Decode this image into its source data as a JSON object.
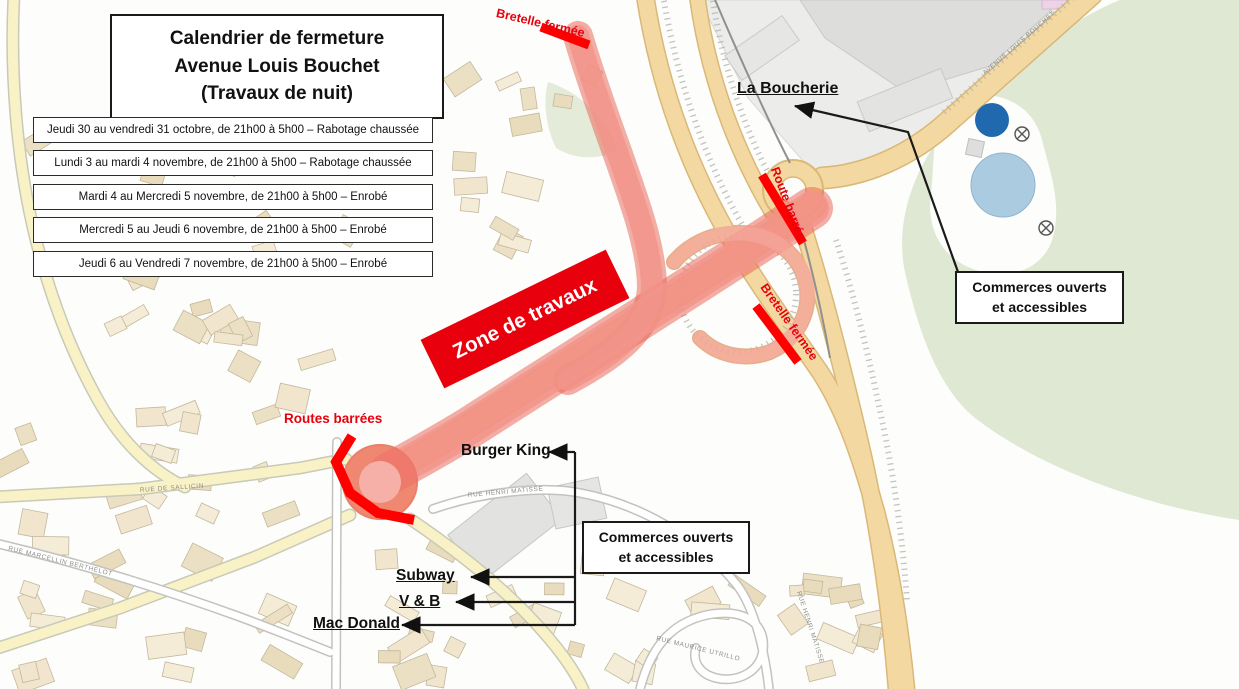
{
  "title": {
    "line1": "Calendrier de fermeture",
    "line2": "Avenue Louis Bouchet",
    "line3": "(Travaux de nuit)"
  },
  "schedule": [
    "Jeudi 30 au vendredi 31 octobre, de 21h00 à 5h00 – Rabotage chaussée",
    "Lundi 3 au mardi 4 novembre, de 21h00 à 5h00 – Rabotage chaussée",
    "Mardi 4 au Mercredi 5 novembre, de 21h00 à 5h00 – Enrobé",
    "Mercredi 5 au Jeudi 6 novembre, de 21h00 à 5h00 – Enrobé",
    "Jeudi 6 au Vendredi 7 novembre, de 21h00 à 5h00 – Enrobé"
  ],
  "annotations": {
    "zone_travaux": "Zone de travaux",
    "bretelle_fermee_top": "Bretelle fermée",
    "route_barree": "Route barrée",
    "bretelle_fermee_east": "Bretelle fermée",
    "routes_barrees": "Routes barrées",
    "la_boucherie": "La Boucherie",
    "commerces_1": {
      "line1": "Commerces ouverts",
      "line2": "et accessibles"
    },
    "commerces_2": {
      "line1": "Commerces ouverts",
      "line2": "et accessibles"
    },
    "burger_king": "Burger King",
    "subway": "Subway",
    "vb": "V & B",
    "mac_donald": "Mac Donald"
  },
  "streets": {
    "avenue_louis_bouchet": "AVENUE LOUIS BOUCHET",
    "rue_de_sallicin": "RUE DE SALLICIN",
    "rue_marcellin_berthelot": "RUE MARCELLIN BERTHELOT",
    "rue_henri_matisse": "RUE HENRI MATISSE",
    "rue_maurice_utrillo": "RUE MAURICE UTRILLO"
  },
  "colors": {
    "accent_red": "#e8000d",
    "closure_bar_red": "#ff0000",
    "works_overlay_pink": "#f2948a",
    "road_tan": "#f3d9a1",
    "road_yellow": "#f8f2c6",
    "park_green": "#dfe8d2",
    "building_beige": "#f1e6cd",
    "commercial_gray": "#ececea",
    "pond_dark_blue": "#2069ae",
    "pond_light_blue": "#abcbe0"
  }
}
